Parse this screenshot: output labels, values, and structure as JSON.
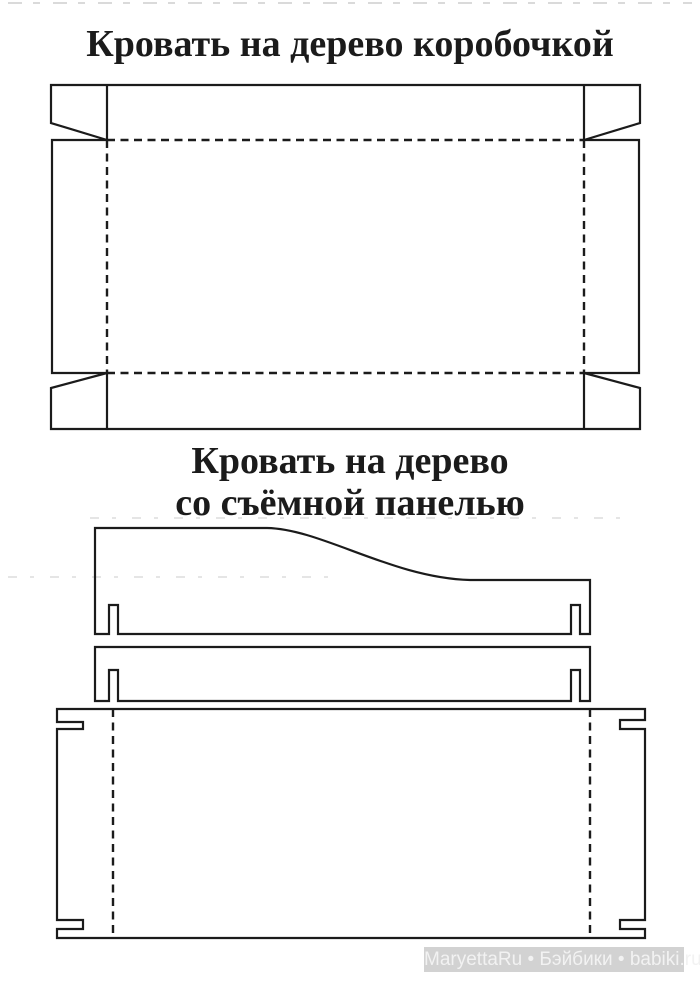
{
  "page": {
    "background": "#ffffff",
    "ink_color": "#1b1b1b"
  },
  "pattern1": {
    "title": "Кровать на дерево коробочкой"
  },
  "pattern2": {
    "title_line1": "Кровать на дерево",
    "title_line2": "со съёмной панелью"
  },
  "watermark": {
    "text": "MaryettaRu • Бэйбики • babiki.ru",
    "bar_color": "#d2d2d2",
    "text_color": "#f2f2f2"
  }
}
